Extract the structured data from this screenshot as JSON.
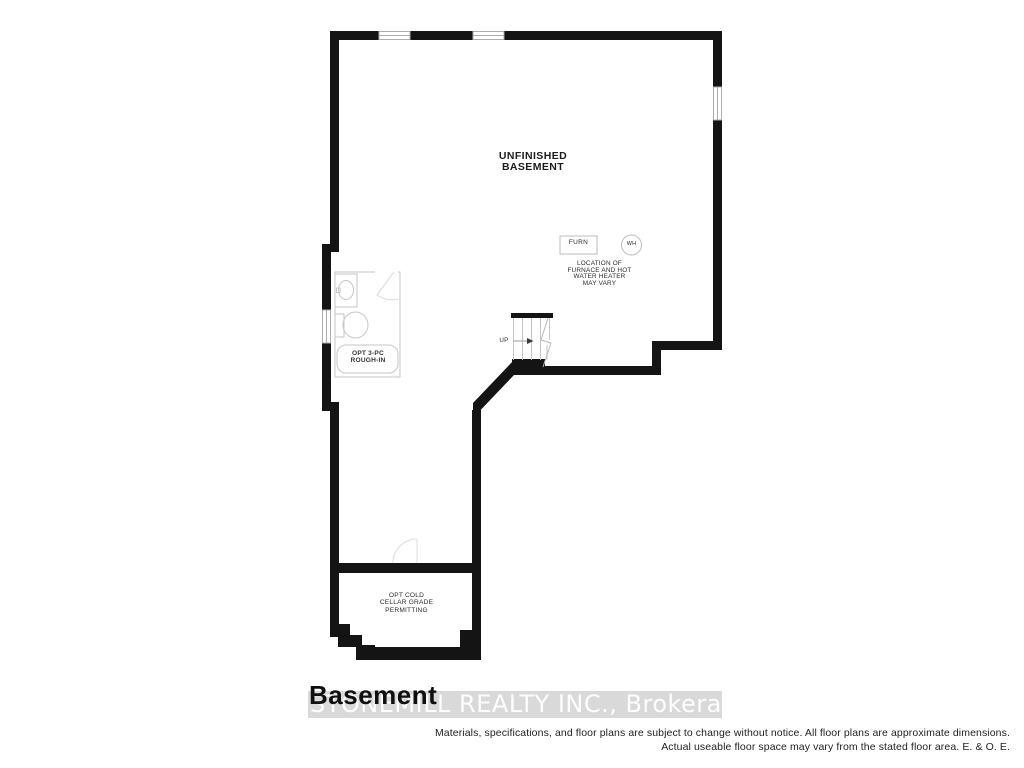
{
  "plan": {
    "unfinished_basement": [
      "UNFINISHED",
      "BASEMENT"
    ],
    "furnace_box": "FURN",
    "water_heater": "WH",
    "furnace_note": [
      "LOCATION OF",
      "FURNACE AND HOT",
      "WATER HEATER",
      "MAY VARY"
    ],
    "bath_rough_in": [
      "OPT 3-PC",
      "ROUGH-IN"
    ],
    "stairs_direction": "UP",
    "cold_cellar": [
      "OPT COLD",
      "CELLAR GRADE",
      "PERMITTING"
    ]
  },
  "footer": {
    "plan_title": "Basement",
    "watermark": "STONEMILL REALTY INC., Brokerage",
    "disclaimer": [
      "Materials, specifications, and floor plans are subject to change without notice. All floor plans are approximate dimensions.",
      "Actual useable floor space may vary from the stated floor area. E. & O. E."
    ]
  },
  "colors": {
    "wall": "#141414",
    "fixture_line": "#c6c6c6",
    "label_text": "#2b2b2b",
    "watermark_band": "#d9d9d9",
    "watermark_text": "#ffffff"
  }
}
